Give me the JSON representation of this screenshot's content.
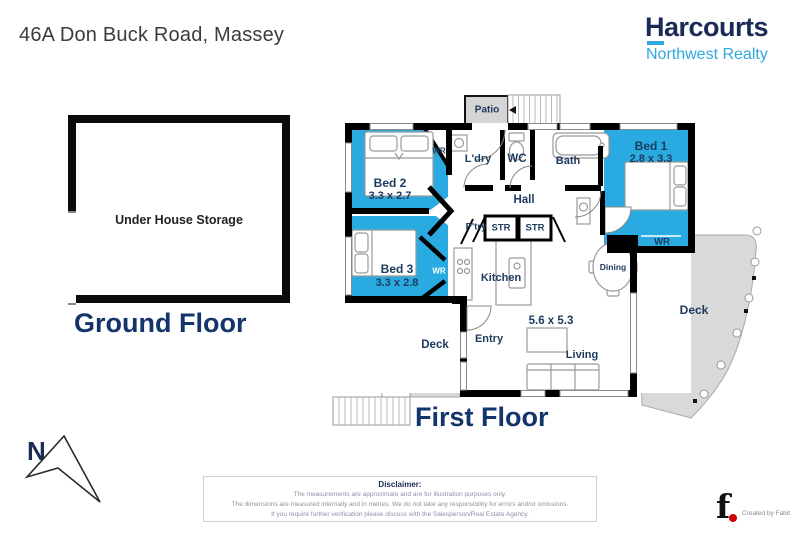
{
  "header": {
    "address": "46A Don Buck Road, Massey"
  },
  "logo": {
    "brand": "Harcourts",
    "subtitle": "Northwest Realty"
  },
  "ground_floor": {
    "title": "Ground Floor",
    "storage_label": "Under House Storage"
  },
  "first_floor": {
    "title": "First Floor",
    "patio": "Patio",
    "laundry": "L'dry",
    "wc": "WC",
    "bath": "Bath",
    "hall": "Hall",
    "pantry": "P'try",
    "storage": "STR",
    "kitchen": "Kitchen",
    "dining": "Dining",
    "living": "Living",
    "entry": "Entry",
    "deck": "Deck",
    "wardrobe": "WR",
    "living_dims": "5.6 x 5.3",
    "bed1": {
      "name": "Bed 1",
      "dims": "2.8 x 3.3"
    },
    "bed2": {
      "name": "Bed 2",
      "dims": "3.3 x 2.7"
    },
    "bed3": {
      "name": "Bed 3",
      "dims": "3.3 x 2.8"
    }
  },
  "compass": {
    "north": "N"
  },
  "disclaimer": {
    "title": "Disclaimer:",
    "line1": "The measurements are approximate and are for illustration purposes only.",
    "line2": "The dimensions are measured internally and in metres. We do not take any responsibility for errors and/or omissions.",
    "line3": "If you require further verification please discuss with the Salesperson/Real Estate Agency."
  },
  "credit": {
    "mark": "f",
    "text": "Created by Fabit"
  },
  "colors": {
    "room_blue": "#29ABE2",
    "deck_gray": "#D9D9D9",
    "navy": "#1A2B57",
    "light_blue": "#2EA9E0"
  }
}
